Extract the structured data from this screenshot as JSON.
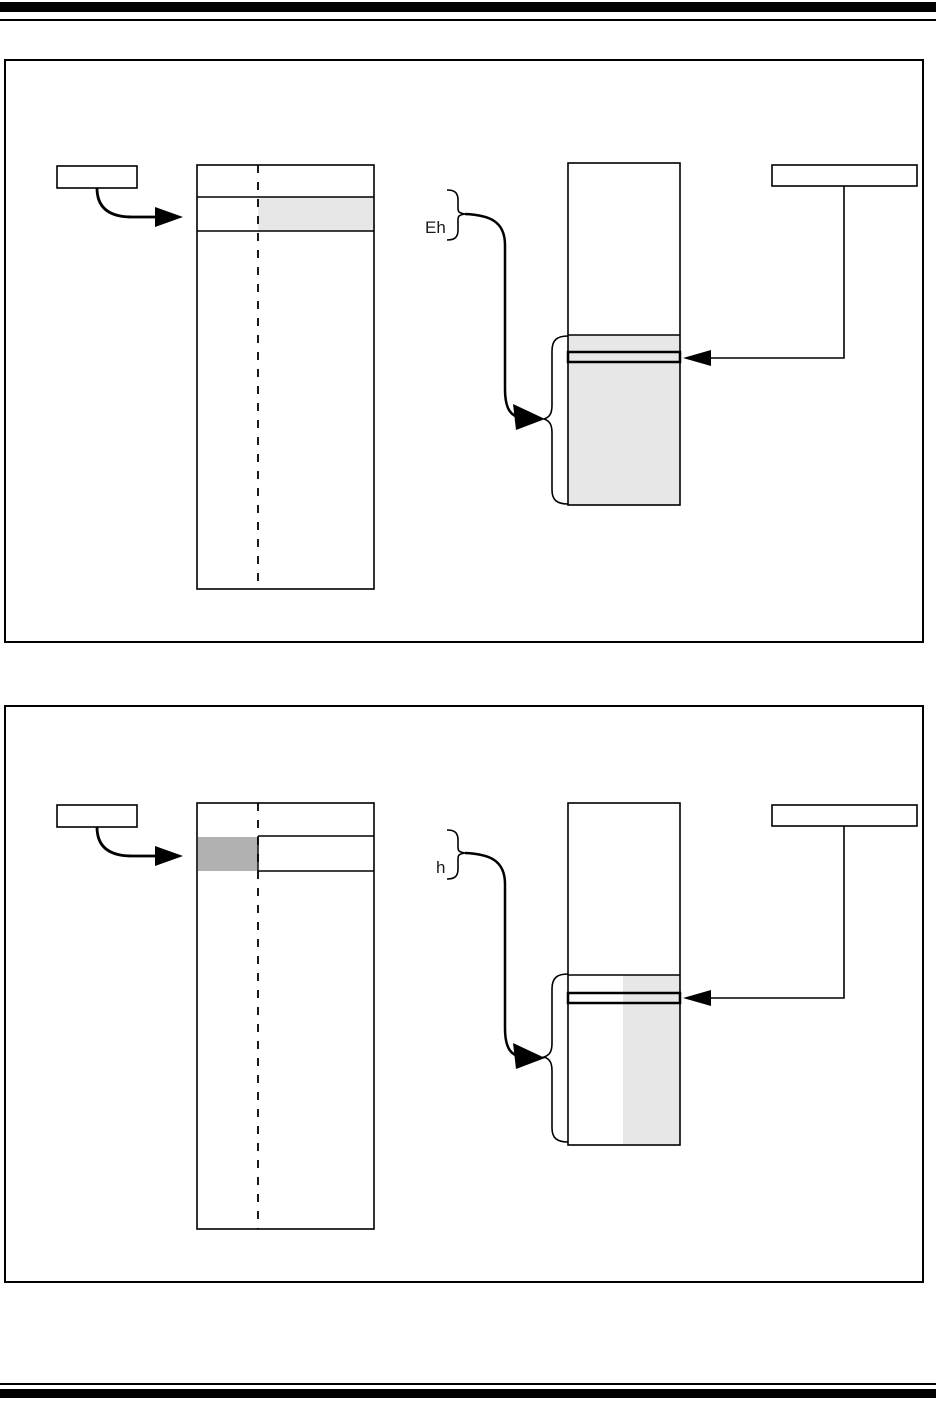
{
  "colors": {
    "page_bg": "#ffffff",
    "line": "#000000",
    "light_gray": "#e7e7e7",
    "medium_gray": "#b1b1b1"
  },
  "figure1": {
    "brace_label": "Eh"
  },
  "figure2": {
    "brace_label": "h"
  }
}
